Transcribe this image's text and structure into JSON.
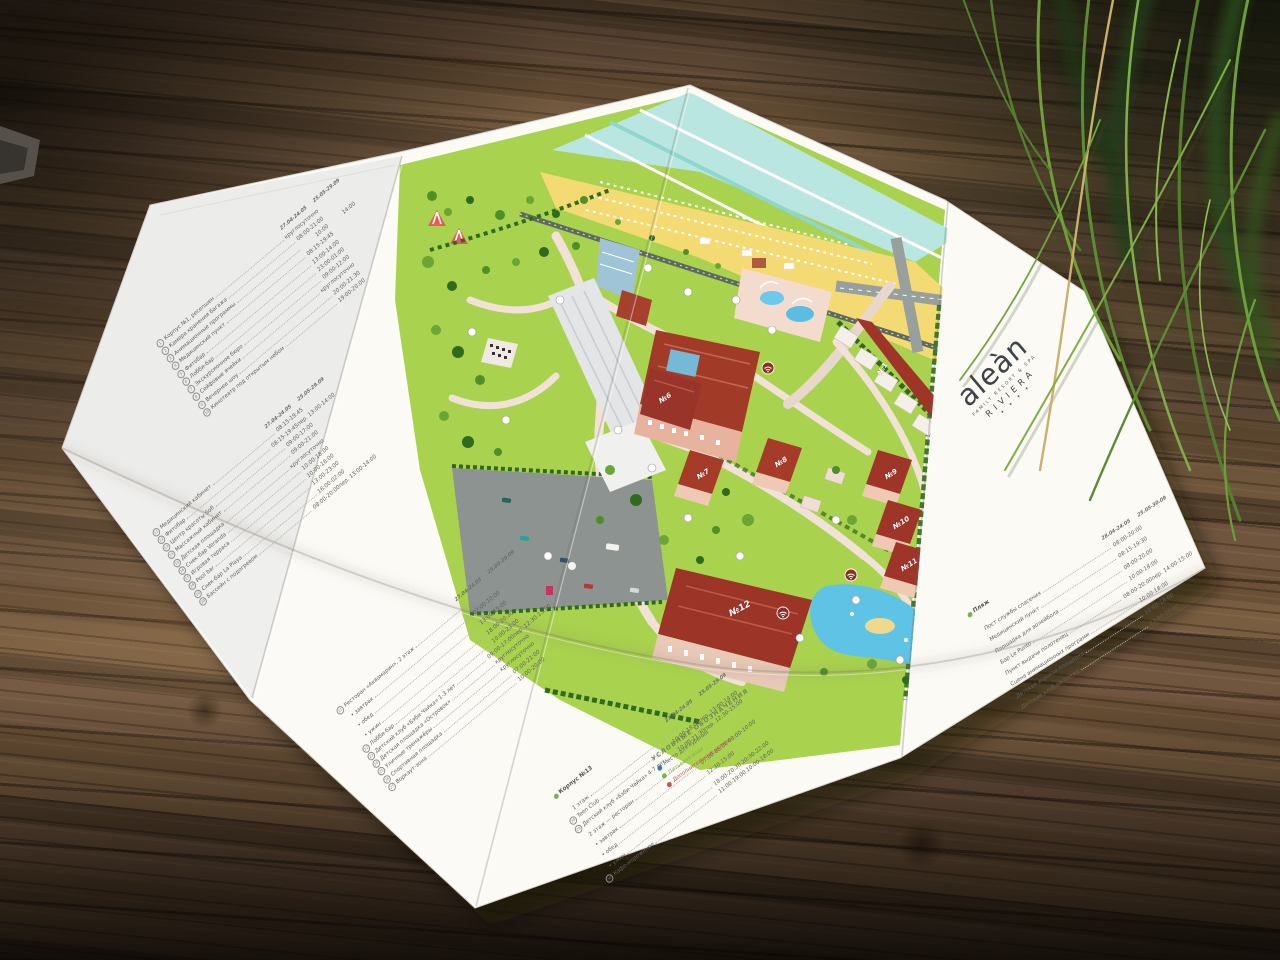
{
  "colors": {
    "paper": "#fbfaf5",
    "map_green": "#a9d24e",
    "path_pink": "#f2e1d6",
    "roof_red": "#a23a28",
    "roof_dark_red": "#8e2f23",
    "pool_blue": "#62c6e8",
    "sea_teal": "#b9e6e0",
    "sand": "#f4da72",
    "parking_gray": "#8d9390",
    "ink_gray": "#62615e",
    "legend_blue": "#2e7bbf",
    "legend_green": "#7ab648",
    "legend_red": "#c9524e",
    "logo_dark": "#3f4347",
    "wood_brown": "#6d5339",
    "grass_green": "#5e8c33"
  },
  "logo": {
    "brand": "aleàn",
    "tagline": "FAMILY RESORT & SPA",
    "name": "RIVIERA",
    "stars": "✦ ✦ ✦ ✦"
  },
  "legend": {
    "title": "УСЛОВНЫЕ ОБОЗНАЧЕНИЯ",
    "items": [
      {
        "label": "Место для курения"
      },
      {
        "label": "Питьевая вода"
      },
      {
        "label": "Дополнительные услуги"
      }
    ]
  },
  "map": {
    "buildings": [
      "№1",
      "№6",
      "№7",
      "№8",
      "№9",
      "№10",
      "№11",
      "№12"
    ]
  },
  "panels": [
    {
      "id": "corpus1",
      "headers": [
        "27.04-24.05",
        "25.05-29.09"
      ],
      "items": [
        {
          "n": "1",
          "label": "Корпус №1, ресепшен",
          "t1": "круглосуточно",
          "t2": ""
        },
        {
          "n": "2",
          "label": "Камера хранения багажа",
          "t1": "08:00-21:00",
          "t2": ""
        },
        {
          "n": "3",
          "label": "Анимационные программы",
          "t1": "10:00",
          "t2": "14:00"
        },
        {
          "n": "4",
          "label": "Медицинский пункт",
          "t1": "08:15-19:45",
          "t2": ""
        },
        {
          "n": "5",
          "label": "Фитобар",
          "t1": "13:00-14:00",
          "t2": ""
        },
        {
          "n": "6",
          "label": "Лобби-бар",
          "t1": "23:00-01:00",
          "t2": ""
        },
        {
          "n": "7",
          "label": "Экскурсионное бюро",
          "t1": "09:00-12:00",
          "t2": ""
        },
        {
          "n": "8",
          "label": "Сейфовые ячейки",
          "t1": "круглосуточно",
          "t2": ""
        },
        {
          "n": "9",
          "label": "Вечернее шоу",
          "t1": "20:00-21:30",
          "t2": ""
        },
        {
          "n": "10",
          "label": "Кинотеатр под открытым небом",
          "t1": "19:00-20:00",
          "t2": ""
        }
      ]
    },
    {
      "id": "services",
      "headers": [
        "27.04-24.05",
        "25.05-29.09"
      ],
      "items": [
        {
          "n": "11",
          "label": "Медицинский кабинет",
          "t1": "08:15-19:45",
          "t2": ""
        },
        {
          "n": "12",
          "label": "Фитобар",
          "t1": "08:15-19:45",
          "t2": "пер. 13:00-14:00"
        },
        {
          "n": "13",
          "label": "Центр красоты Sofi",
          "t1": "09:00-17:00",
          "t2": ""
        },
        {
          "n": "14",
          "label": "Массажный кабинет",
          "t1": "09:00-21:00",
          "t2": ""
        },
        {
          "n": "15",
          "label": "Детская площадка",
          "t1": "круглосуточно",
          "t2": ""
        },
        {
          "n": "16",
          "label": "Снек-бар Veranda",
          "t1": "10:00-18:00",
          "t2": ""
        },
        {
          "n": "17",
          "label": "Игровая терраса",
          "t1": "10:00-16:00",
          "t2": ""
        },
        {
          "n": "18",
          "label": "Pool bar",
          "t1": "13:00-23:00",
          "t2": ""
        },
        {
          "n": "19",
          "label": "Снек-бар La Playa",
          "t1": "16:00-02:00",
          "t2": ""
        },
        {
          "n": "20",
          "label": "Бассейн с подогревом",
          "t1": "08:00-20:00",
          "t2": "пер. 13:00-14:00"
        }
      ]
    },
    {
      "id": "restaurant",
      "headers": [
        "27.04-24.05",
        "25.05-29.09"
      ],
      "items": [
        {
          "n": "21",
          "label": "Ресторан «Аквамарин», 2 этаж",
          "t1": "",
          "t2": ""
        },
        {
          "n": "",
          "label": "• завтрак",
          "t1": "07:00-10:00",
          "t2": ""
        },
        {
          "n": "",
          "label": "• обед",
          "t1": "13:00-15:00",
          "t2": ""
        },
        {
          "n": "",
          "label": "• ужин",
          "t1": "18:00-20:30",
          "t2": ""
        },
        {
          "n": "22",
          "label": "Лобби-бар",
          "t1": "10:00-23:00",
          "t2": ""
        },
        {
          "n": "23",
          "label": "Детский клуб «Бэби-Чайка» 1-3 лет",
          "t1": "09:00-17:00",
          "t2": "пер. 12:30-13:00"
        },
        {
          "n": "24",
          "label": "Детская площадка «Островок»",
          "t1": "круглосуточно",
          "t2": ""
        },
        {
          "n": "25",
          "label": "Уличные тренажёры",
          "t1": "круглосуточно",
          "t2": ""
        },
        {
          "n": "26",
          "label": "Спортивная площадка",
          "t1": "07:00-21:00",
          "t2": ""
        },
        {
          "n": "27",
          "label": "Воркаут-зона",
          "t1": "10:00-20:00",
          "t2": ""
        }
      ]
    },
    {
      "id": "corpus13",
      "title": "Корпус №13",
      "headers": [
        "27.04-24.05",
        "25.05-29.09"
      ],
      "items": [
        {
          "n": "",
          "label": "1 этаж",
          "t1": "",
          "t2": ""
        },
        {
          "n": "28",
          "label": "Teen Club",
          "t1": "10:00-18:00",
          "t2": "пер. 13:00-14:00"
        },
        {
          "n": "29",
          "label": "Детский клуб «Бэби-Чайка» 4-7 лет",
          "t1": "10:00-21:30",
          "t2": "пер. 12:30-15:00"
        },
        {
          "n": "",
          "label": "2 этаж — ресторан",
          "t1": "",
          "t2": ""
        },
        {
          "n": "",
          "label": "• завтрак",
          "t1": "07:00-08:00",
          "t2": "08:00-10:00"
        },
        {
          "n": "",
          "label": "• обед",
          "t1": "12:30-15:00",
          "t2": ""
        },
        {
          "n": "",
          "label": "• ужин",
          "t1": "18:00-20:30",
          "t2": "20:30-22:00"
        },
        {
          "n": "30",
          "label": "Кафе-мороженое",
          "t1": "11:00-19:00",
          "t2": "10:00-18:00"
        }
      ]
    },
    {
      "id": "beach",
      "title": "Пляж",
      "headers": [
        "28.04-24.05",
        "25.05-30.09"
      ],
      "items": [
        {
          "n": "",
          "label": "Пост службы спасения",
          "t1": "08:00-20:00",
          "t2": ""
        },
        {
          "n": "",
          "label": "Медицинский пункт",
          "t1": "08:15-19:30",
          "t2": ""
        },
        {
          "n": "",
          "label": "Площадка для волейбола",
          "t1": "08:00-20:00",
          "t2": ""
        },
        {
          "n": "",
          "label": "Бар Le Punto",
          "t1": "10:00-18:00",
          "t2": ""
        },
        {
          "n": "",
          "label": "Пункт выдачи полотенец",
          "t1": "08:00-20:00",
          "t2": "пер. 14:00-15:00"
        },
        {
          "n": "",
          "label": "Сцена анимационных программ",
          "t1": "10:00-18:00",
          "t2": ""
        },
        {
          "n": "",
          "label": "Детская игровая площадка",
          "t1": "10:00-18:00",
          "t2": ""
        },
        {
          "n": "",
          "label": "Детский клуб на пляже",
          "t1": "13:00-15:00",
          "t2": ""
        }
      ]
    }
  ]
}
